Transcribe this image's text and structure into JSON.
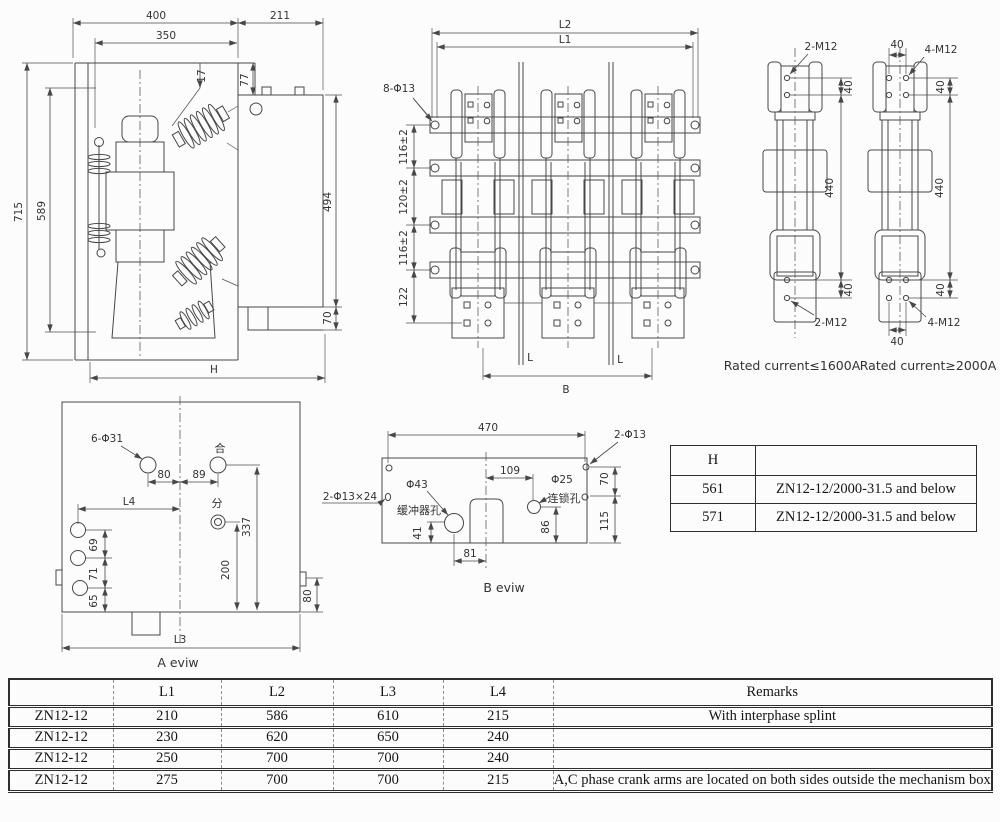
{
  "palette": {
    "line": "#474747",
    "text": "#333333",
    "table_border": "#2e2e2e",
    "background": "#fcfcfc"
  },
  "side_view": {
    "d400": "400",
    "d211": "211",
    "d350": "350",
    "d17": "17",
    "d77": "77",
    "d715": "715",
    "d589": "589",
    "d494": "494",
    "d70": "70",
    "dH": "H"
  },
  "front_view": {
    "dL2": "L2",
    "dL1": "L1",
    "dHoles": "8-Φ13",
    "dV1": "116±2",
    "dV2": "120±2",
    "dV3": "116±2",
    "dV4": "122",
    "dRod": "L",
    "dB": "B"
  },
  "pole_views": {
    "d40": "40",
    "d440": "440",
    "left": {
      "bolts": "2-M12",
      "caption": "Rated current≤1600A"
    },
    "right": {
      "bolts": "4-M12",
      "caption": "Rated current≥2000A"
    }
  },
  "a_view": {
    "holes": "6-Φ31",
    "d80": "80",
    "d89": "89",
    "close_sym": "合",
    "open_sym": "分",
    "dL4": "L4",
    "d69": "69",
    "d71": "71",
    "d65": "65",
    "d337": "337",
    "d200": "200",
    "d80_right": "80",
    "dL3": "L3",
    "caption": "A eviw"
  },
  "b_view": {
    "d470": "470",
    "holes2": "2-Φ13",
    "holes_slot": "2-Φ13×24",
    "buffer_dia": "Φ43",
    "buffer_label": "缓冲器孔",
    "d109": "109",
    "interlock_dia": "Φ25",
    "interlock_label": "连锁孔",
    "d41": "41",
    "d81": "81",
    "d86": "86",
    "d70": "70",
    "d115": "115",
    "caption": "B eviw"
  },
  "h_table": {
    "header": "H",
    "rows": [
      [
        "561",
        "ZN12-12/2000-31.5 and below"
      ],
      [
        "571",
        "ZN12-12/2000-31.5 and below"
      ]
    ]
  },
  "main_table": {
    "headers": [
      "",
      "L1",
      "L2",
      "L3",
      "L4",
      "Remarks"
    ],
    "rows": [
      [
        "ZN12-12",
        "210",
        "586",
        "610",
        "215",
        "With interphase splint"
      ],
      [
        "ZN12-12",
        "230",
        "620",
        "650",
        "240",
        ""
      ],
      [
        "ZN12-12",
        "250",
        "700",
        "700",
        "240",
        ""
      ],
      [
        "ZN12-12",
        "275",
        "700",
        "700",
        "215",
        "A,C phase crank arms are located on both sides outside the mechanism box"
      ]
    ]
  }
}
